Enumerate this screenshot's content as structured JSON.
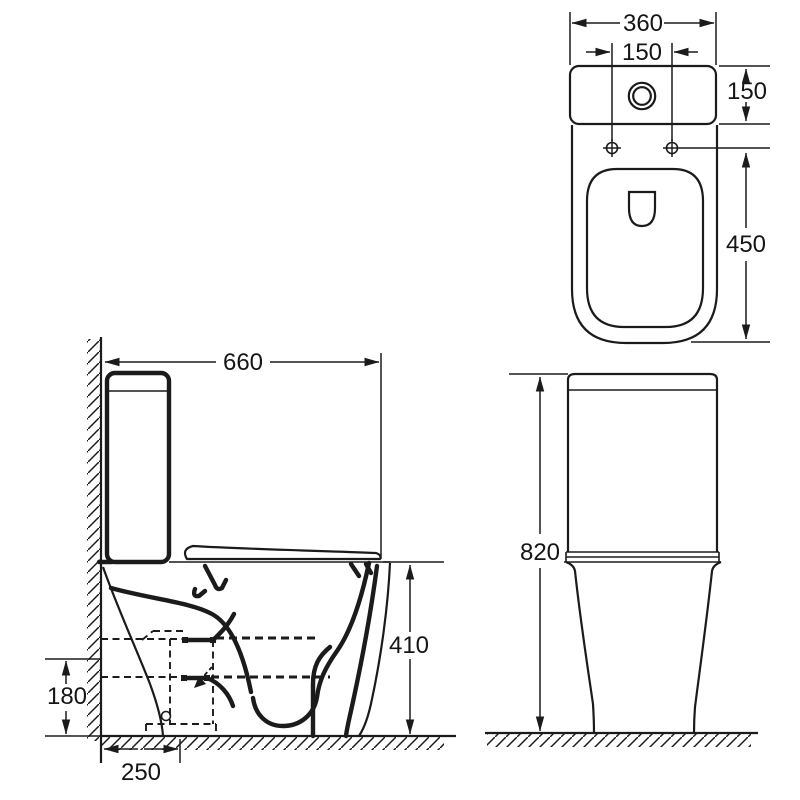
{
  "colors": {
    "ink": "#1b1b1b",
    "paper": "#ffffff"
  },
  "dims": {
    "top_width": "360",
    "hole_spacing": "150",
    "cistern_depth": "150",
    "pan_length": "450",
    "side_depth": "660",
    "rim_height": "410",
    "outlet_height": "180",
    "outlet_offset": "250",
    "total_height": "820"
  }
}
